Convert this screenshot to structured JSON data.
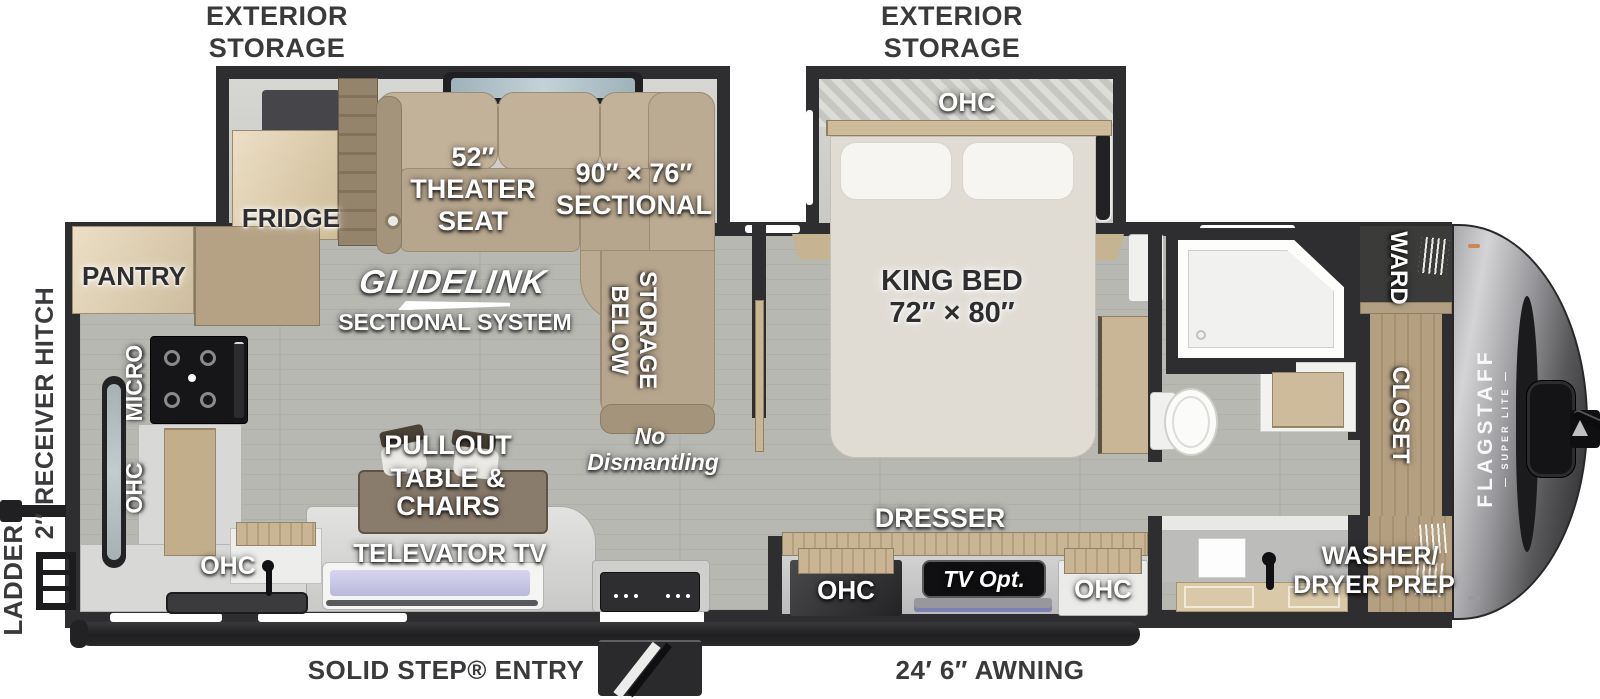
{
  "plan": {
    "exterior": {
      "storage_left_1": "EXTERIOR",
      "storage_left_2": "STORAGE",
      "storage_right_1": "EXTERIOR",
      "storage_right_2": "STORAGE",
      "ladder": "LADDER",
      "receiver_hitch": "2″ RECEIVER HITCH",
      "solid_step_entry": "SOLID STEP® ENTRY",
      "awning": "24′ 6″ AWNING"
    },
    "kitchen": {
      "pantry": "PANTRY",
      "fridge": "FRIDGE",
      "micro": "MICRO",
      "ohc_wall": "OHC",
      "ohc_sink": "OHC"
    },
    "living": {
      "theater_1": "52″",
      "theater_2": "THEATER",
      "theater_3": "SEAT",
      "sectional_1": "90″ × 76″",
      "sectional_2": "SECTIONAL",
      "glidelink": "GLIDELINK",
      "glidelink_sub": "SECTIONAL SYSTEM",
      "storage_below_1": "STORAGE",
      "storage_below_2": "BELOW",
      "no_dismantling_1": "No",
      "no_dismantling_2": "Dismantling",
      "pullout_1": "PULLOUT",
      "pullout_2": "TABLE &",
      "pullout_3": "CHAIRS",
      "televator": "TELEVATOR TV"
    },
    "bedroom": {
      "ohc_head": "OHC",
      "king_bed_1": "KING BED",
      "king_bed_2": "72″ × 80″",
      "dresser": "DRESSER",
      "ohc_left": "OHC",
      "tv_opt": "TV Opt.",
      "ohc_right": "OHC"
    },
    "bath_front": {
      "ward": "WARD",
      "closet": "CLOSET",
      "washer_1": "WASHER/",
      "washer_2": "DRYER PREP",
      "brand": "FLAGSTAFF",
      "brand_sub": "—  SUPER LITE  —"
    },
    "colors": {
      "wall": "#2e2e30",
      "floor": "#b7b8b2",
      "sofa": "#c1b098",
      "wood": "#c4b08d",
      "front_cap": "#39393b"
    }
  }
}
